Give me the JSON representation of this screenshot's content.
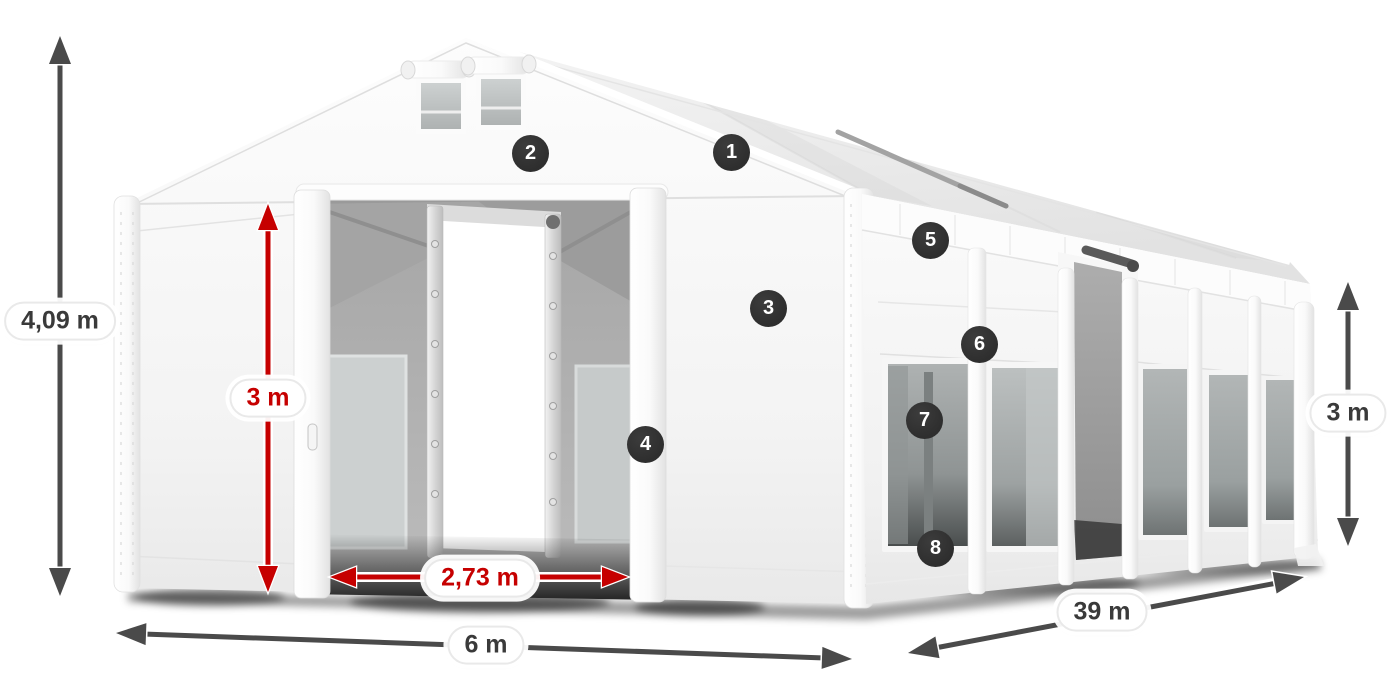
{
  "page": {
    "background": "#ffffff",
    "width": 1400,
    "height": 700
  },
  "colors": {
    "page_bg": "#ffffff",
    "dimension_arrow": "#4a4a4a",
    "highlight_arrow": "#c60000",
    "badge_bg": "#2e2e2e",
    "badge_text": "#ffffff",
    "label_bg": "#ffffff",
    "label_border": "#e9e9e9",
    "label_text_dark": "#3a3a3a",
    "label_text_red": "#c60000"
  },
  "dimensions": {
    "total_height": {
      "label": "4,09 m",
      "color": "dark"
    },
    "door_height": {
      "label": "3 m",
      "color": "red"
    },
    "door_width": {
      "label": "2,73 m",
      "color": "red"
    },
    "width": {
      "label": "6 m",
      "color": "dark"
    },
    "length": {
      "label": "39 m",
      "color": "dark"
    },
    "side_height": {
      "label": "3 m",
      "color": "dark"
    }
  },
  "badges": [
    {
      "label": "1"
    },
    {
      "label": "2"
    },
    {
      "label": "3"
    },
    {
      "label": "4"
    },
    {
      "label": "5"
    },
    {
      "label": "6"
    },
    {
      "label": "7"
    },
    {
      "label": "8"
    }
  ]
}
